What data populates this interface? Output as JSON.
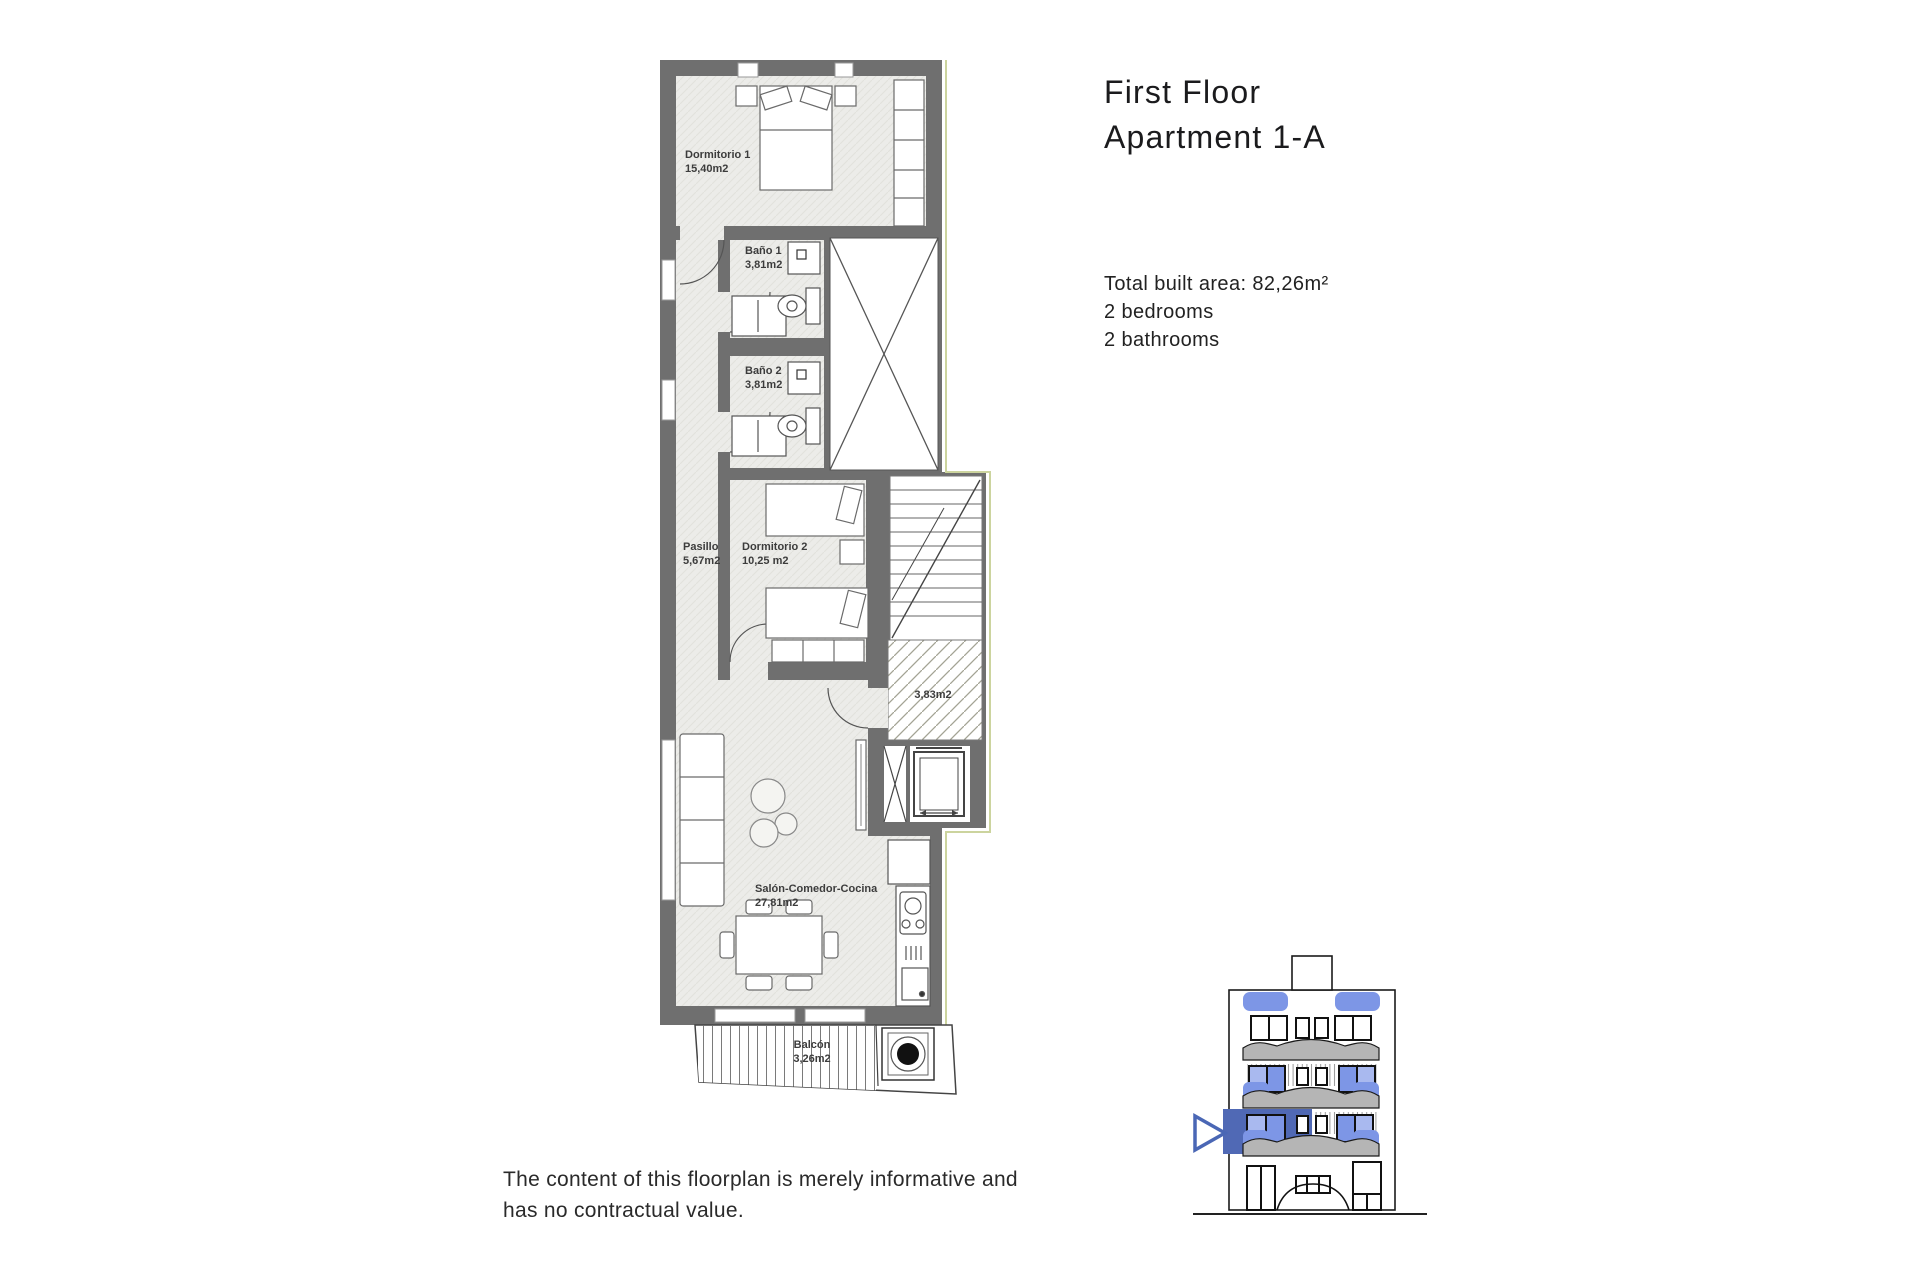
{
  "title": {
    "line1": "First Floor",
    "line2": "Apartment 1-A"
  },
  "summary": {
    "total_area": "Total built area: 82,26m²",
    "bedrooms": "2 bedrooms",
    "bathrooms": "2 bathrooms"
  },
  "disclaimer": {
    "line1": "The content of this floorplan is merely informative and",
    "line2": "has no contractual value."
  },
  "floorplan": {
    "rooms": {
      "dormitorio1": {
        "name": "Dormitorio 1",
        "area": "15,40m2"
      },
      "bano1": {
        "name": "Baño 1",
        "area": "3,81m2"
      },
      "bano2": {
        "name": "Baño 2",
        "area": "3,81m2"
      },
      "pasillo": {
        "name": "Pasillo",
        "area": "5,67m2"
      },
      "dormitorio2": {
        "name": "Dormitorio 2",
        "area": "10,25 m2"
      },
      "landing": {
        "area": "3,83m2"
      },
      "salon": {
        "name": "Salón-Comedor-Cocina",
        "area": "27,81m2"
      },
      "balcon": {
        "name": "Balcón",
        "area": "3,26m2"
      }
    },
    "colors": {
      "wall": "#6f6f6f",
      "floor": "#ebebe8",
      "boundary": "#ccd49e",
      "hatch": "#a3a394"
    }
  },
  "elevation": {
    "highlight": "#5069b5",
    "window_blue": "#7d96e6",
    "window_blue_light": "#a9b9ef",
    "canopy": "#b5b5b5"
  }
}
